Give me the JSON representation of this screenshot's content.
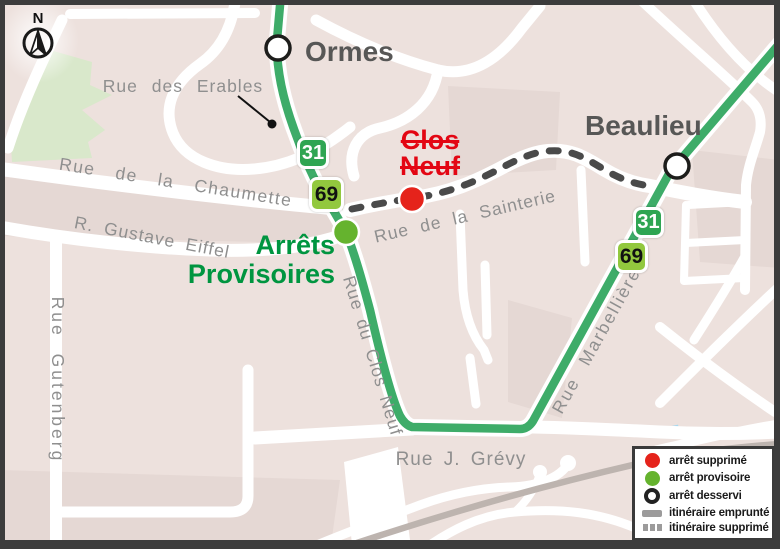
{
  "map": {
    "type": "transit-detour-map",
    "compass": {
      "north": "N"
    },
    "stops": {
      "ormes": {
        "label": "Ormes",
        "status": "arrêt desservi"
      },
      "beaulieu": {
        "label": "Beaulieu",
        "status": "arrêt desservi"
      },
      "clos_neuf": {
        "label": "Clos\nNeuf",
        "status": "arrêt supprimé"
      },
      "arrets_provisoires": {
        "label": "Arrêts\nProvisoires",
        "status": "arrêt provisoire"
      }
    },
    "route_badges": {
      "line31": "31",
      "line69": "69"
    },
    "streets": {
      "erables": "Rue des Erables",
      "chaumette": "Rue de la Chaumette",
      "eiffel": "R. Gustave Eiffel",
      "gutenberg": "Rue Gutenberg",
      "clos_neuf": "Rue du Clos Neuf",
      "sainterie": "Rue de la Sainterie",
      "grevy": "Rue J. Grévy",
      "marbelliere": "Rue Marbellière"
    },
    "legend": {
      "items": [
        {
          "icon": "red-dot",
          "label": "arrêt supprimé"
        },
        {
          "icon": "green-dot",
          "label": "arrêt provisoire"
        },
        {
          "icon": "white-circle",
          "label": "arrêt desservi"
        },
        {
          "icon": "solid-bar",
          "label": "itinéraire emprunté"
        },
        {
          "icon": "dashed-bar",
          "label": "itinéraire supprimé"
        }
      ]
    },
    "colors": {
      "background": "#EDE1DD",
      "background_dark": "#E5D8D4",
      "road": "#FFFFFF",
      "park": "#D9E8CB",
      "water": "#A8D9F0",
      "route_green": "#3EAC69",
      "badge_31": "#2FA552",
      "badge_69": "#92C83E",
      "stop_removed_red": "#E5231B",
      "stop_temp_green": "#65B32E",
      "removed_route_gray": "#4A4A4A",
      "railway_gray": "#BDB4AF",
      "street_label_gray": "#8F8F8F",
      "place_label_gray": "#575756"
    }
  }
}
